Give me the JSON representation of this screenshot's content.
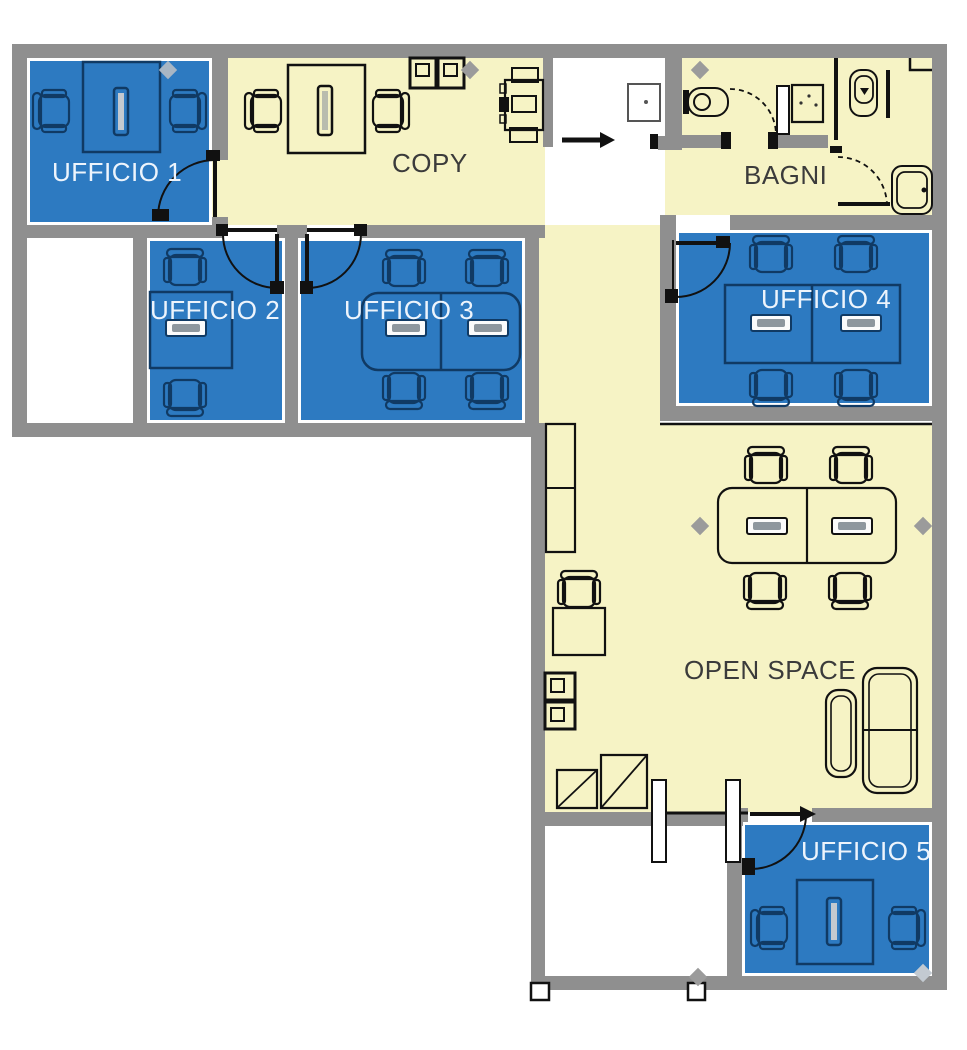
{
  "floorplan": {
    "rooms": {
      "ufficio1": {
        "label": "UFFICIO 1",
        "type": "office"
      },
      "ufficio2": {
        "label": "UFFICIO 2",
        "type": "office"
      },
      "ufficio3": {
        "label": "UFFICIO 3",
        "type": "office"
      },
      "ufficio4": {
        "label": "UFFICIO 4",
        "type": "office"
      },
      "ufficio5": {
        "label": "UFFICIO 5",
        "type": "office"
      },
      "copy": {
        "label": "COPY",
        "type": "common"
      },
      "bagni": {
        "label": "BAGNI",
        "type": "common"
      },
      "open_space": {
        "label": "OPEN SPACE",
        "type": "common"
      }
    },
    "colors": {
      "office_fill": "#2d7ac1",
      "common_fill": "#f6f3c5",
      "wall": "#8f8f8f",
      "navy": "#103a64",
      "ink": "#111111",
      "office_label": "#edf4fc",
      "common_label": "#3b3b3b",
      "diamond": "#9b9b9b"
    }
  }
}
